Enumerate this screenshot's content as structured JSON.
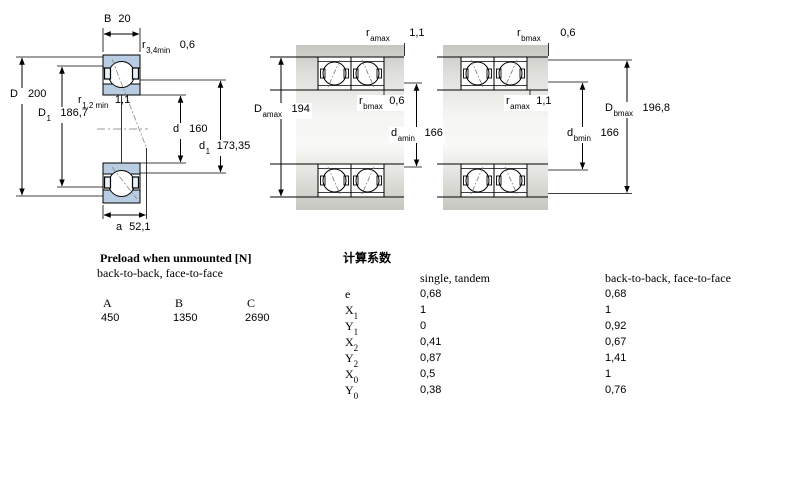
{
  "dims": {
    "B": {
      "base": "B",
      "sub": "",
      "value": "20"
    },
    "r34": {
      "base": "r",
      "sub": "3,4min",
      "value": "0,6"
    },
    "D": {
      "base": "D",
      "sub": "",
      "value": "200"
    },
    "D1": {
      "base": "D",
      "sub": "1",
      "value": "186,7"
    },
    "r12": {
      "base": "r",
      "sub": "1,2 min",
      "value": "1,1"
    },
    "d": {
      "base": "d",
      "sub": "",
      "value": "160"
    },
    "d1": {
      "base": "d",
      "sub": "1",
      "value": "173,35"
    },
    "a": {
      "base": "a",
      "sub": "",
      "value": "52,1"
    },
    "ramax_top": {
      "base": "r",
      "sub": "amax",
      "value": "1,1"
    },
    "Damax": {
      "base": "D",
      "sub": "amax",
      "value": "194"
    },
    "rbmax_mid": {
      "base": "r",
      "sub": "bmax",
      "value": "0,6"
    },
    "damin": {
      "base": "d",
      "sub": "amin",
      "value": "166"
    },
    "rbmax_top": {
      "base": "r",
      "sub": "bmax",
      "value": "0,6"
    },
    "ramax_mid": {
      "base": "r",
      "sub": "amax",
      "value": "1,1"
    },
    "Dbmax": {
      "base": "D",
      "sub": "bmax",
      "value": "196,8"
    },
    "dbmin": {
      "base": "d",
      "sub": "bmin",
      "value": "166"
    }
  },
  "preload": {
    "title": "Preload when unmounted [N]",
    "subtitle": "back-to-back, face-to-face",
    "columns": [
      "A",
      "B",
      "C"
    ],
    "values": [
      "450",
      "1350",
      "2690"
    ]
  },
  "factors": {
    "title": "计算系数",
    "col1_header": "single, tandem",
    "col2_header": "back-to-back, face-to-face",
    "rows": [
      {
        "label": "e",
        "sub": "",
        "c1": "0,68",
        "c2": "0,68"
      },
      {
        "label": "X",
        "sub": "1",
        "c1": "1",
        "c2": "1"
      },
      {
        "label": "Y",
        "sub": "1",
        "c1": "0",
        "c2": "0,92"
      },
      {
        "label": "X",
        "sub": "2",
        "c1": "0,41",
        "c2": "0,67"
      },
      {
        "label": "Y",
        "sub": "2",
        "c1": "0,87",
        "c2": "1,41"
      },
      {
        "label": "X",
        "sub": "0",
        "c1": "0,5",
        "c2": "1"
      },
      {
        "label": "Y",
        "sub": "0",
        "c1": "0,38",
        "c2": "0,76"
      }
    ]
  },
  "colors": {
    "ring_fill": "#b8cce2",
    "band_gray": "#c6c6c1",
    "line": "#000000"
  }
}
